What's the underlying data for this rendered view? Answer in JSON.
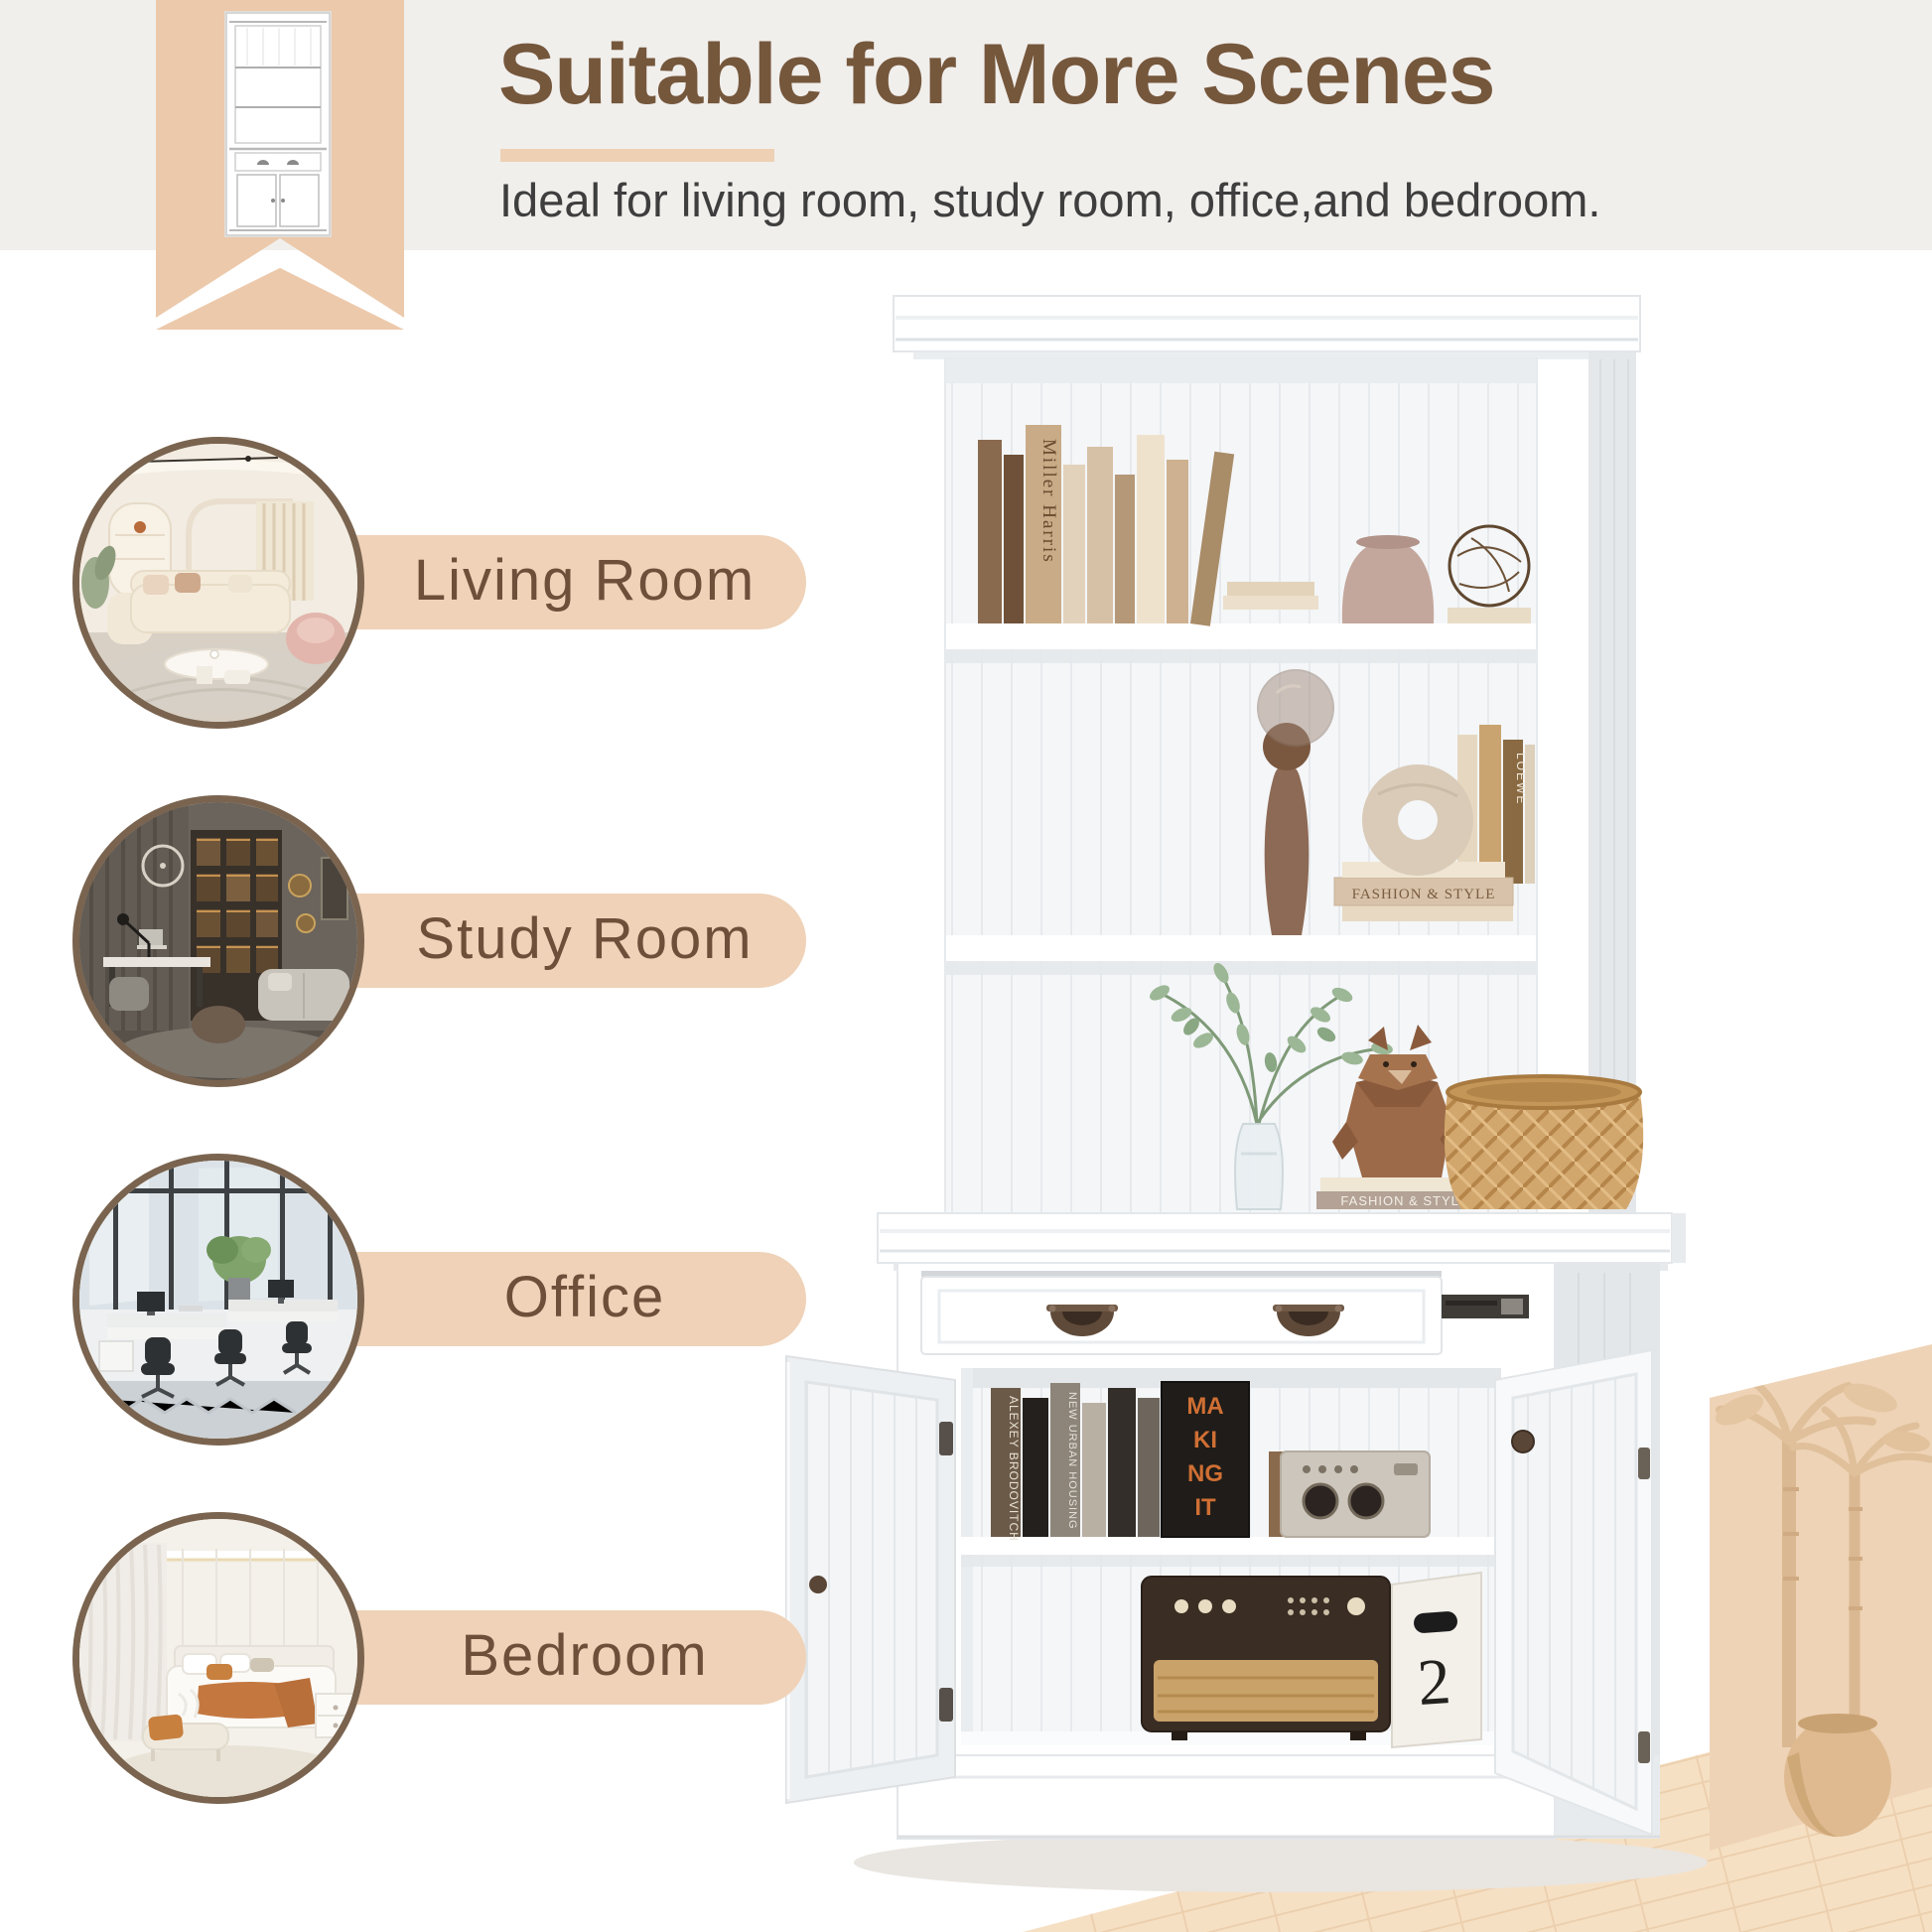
{
  "colors": {
    "page_bg": "#ffffff",
    "top_band": "#f1efec",
    "ribbon_beige": "#ecc9ab",
    "title_brown": "#75573c",
    "underline_beige": "#eed0b4",
    "subtitle_gray": "#3e3e3e",
    "pill_beige": "#efd2b8",
    "pill_text_brown": "#6d4f3a",
    "circle_border_brown": "#7a644f",
    "scene_wall_beige": "#eed3b6",
    "scene_floor_beige": "#f6e0c4"
  },
  "header": {
    "title": "Suitable for More Scenes",
    "subtitle": "Ideal for living room, study room, office,and bedroom."
  },
  "scenes": [
    {
      "id": "living-room",
      "label": "Living Room"
    },
    {
      "id": "study-room",
      "label": "Study Room"
    },
    {
      "id": "office",
      "label": "Office"
    },
    {
      "id": "bedroom",
      "label": "Bedroom"
    }
  ],
  "product": {
    "spines": {
      "miller_harris": "Miller Harris",
      "fashion_style_upper": "FASHION & STYLE",
      "fashion_style_lower": "FASHION & STYLE",
      "loewe": "LOEWE",
      "alexey_brodovitch": "ALEXEY BRODOVITCH",
      "new_urban_housing": "NEW URBAN HOUSING",
      "making_it_lines": [
        "MA",
        "KI",
        "NG",
        "IT"
      ],
      "box_number": "2"
    }
  }
}
